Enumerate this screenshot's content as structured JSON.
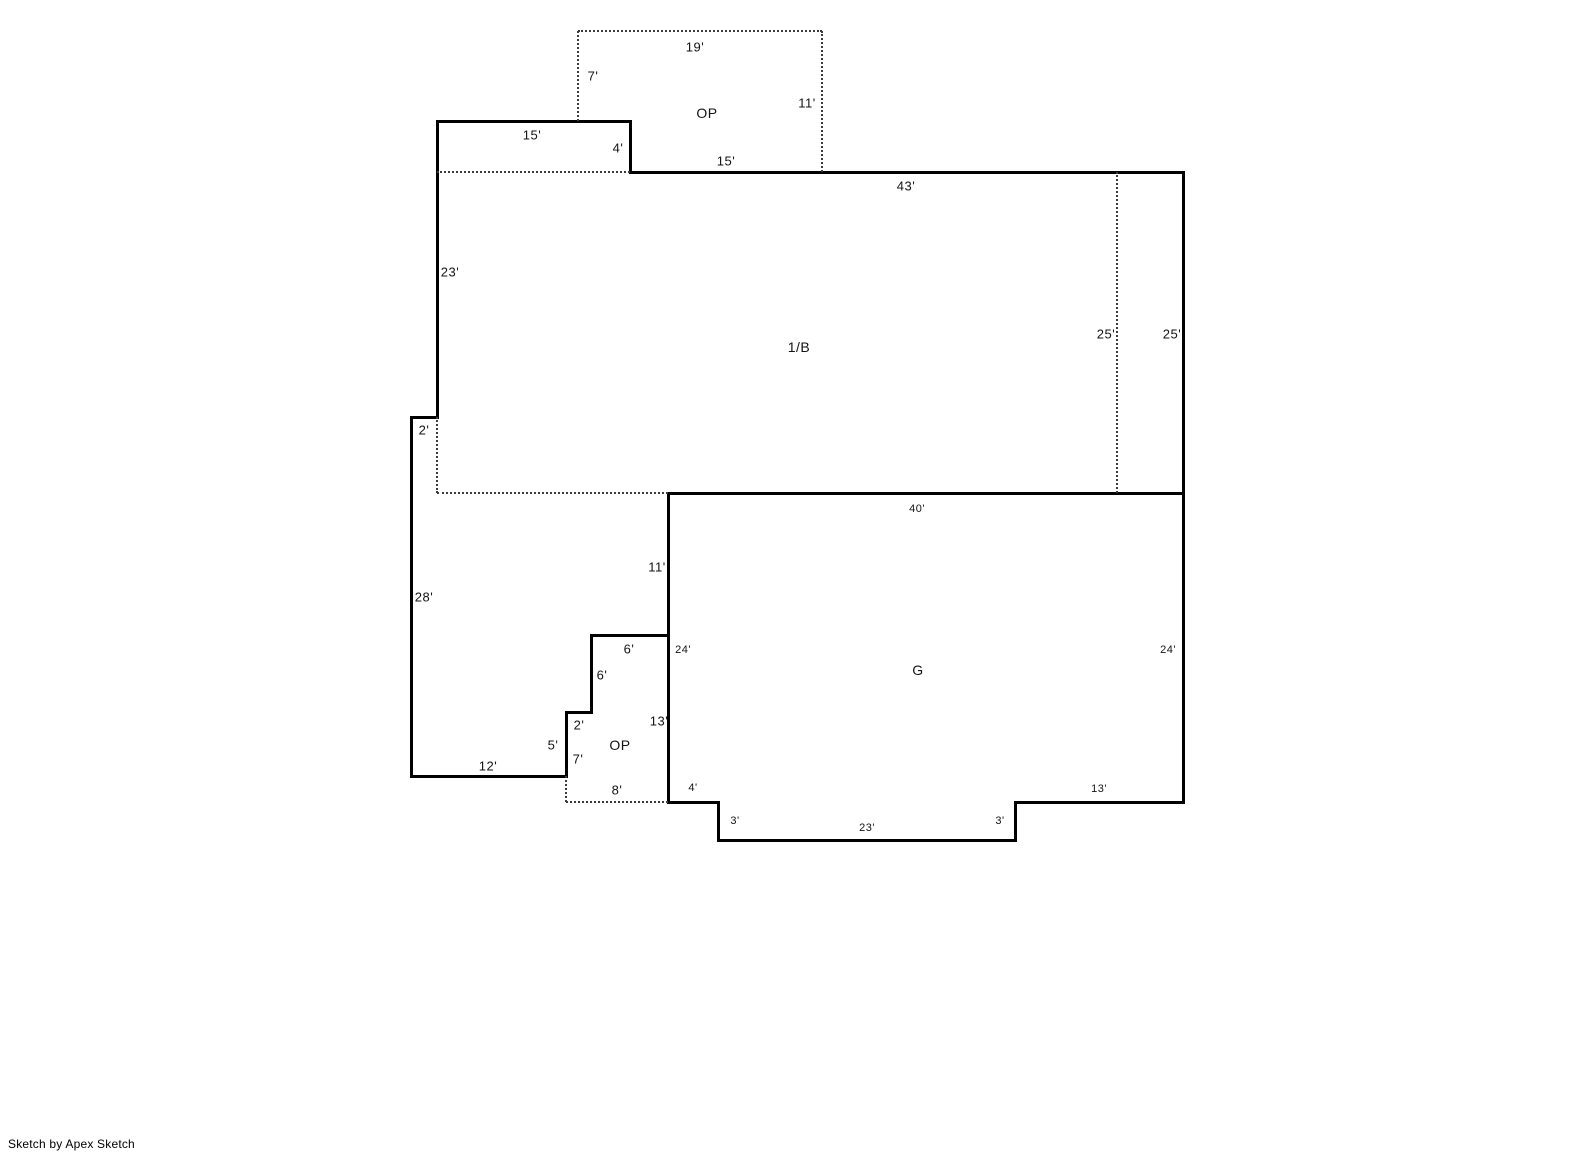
{
  "footer": {
    "credit": "Sketch by Apex Sketch"
  },
  "canvas": {
    "width": 1585,
    "height": 1163,
    "background": "#ffffff",
    "wall_color": "#000000",
    "dotted_color": "#3c3c3c",
    "text_color": "#141414"
  },
  "floorplan": {
    "scale_px_per_foot": 13,
    "area_labels": [
      {
        "text": "OP",
        "name": "area-label-open-porch-top",
        "x": 707,
        "y": 113
      },
      {
        "text": "1/B",
        "name": "area-label-first-floor-basement",
        "x": 799,
        "y": 347
      },
      {
        "text": "G",
        "name": "area-label-garage",
        "x": 918,
        "y": 670
      },
      {
        "text": "OP",
        "name": "area-label-open-porch-bottom",
        "x": 620,
        "y": 745
      }
    ],
    "dimension_labels": [
      {
        "text": "19'",
        "x": 695,
        "y": 47
      },
      {
        "text": "7'",
        "x": 593,
        "y": 76
      },
      {
        "text": "11'",
        "x": 807,
        "y": 103
      },
      {
        "text": "15'",
        "x": 532,
        "y": 135
      },
      {
        "text": "4'",
        "x": 618,
        "y": 148
      },
      {
        "text": "15'",
        "x": 726,
        "y": 161
      },
      {
        "text": "43'",
        "x": 906,
        "y": 186
      },
      {
        "text": "23'",
        "x": 450,
        "y": 272
      },
      {
        "text": "25'",
        "x": 1106,
        "y": 334
      },
      {
        "text": "25'",
        "x": 1172,
        "y": 334
      },
      {
        "text": "2'",
        "x": 424,
        "y": 430
      },
      {
        "text": "40'",
        "x": 917,
        "y": 509,
        "small": true
      },
      {
        "text": "11'",
        "x": 657,
        "y": 567
      },
      {
        "text": "28'",
        "x": 424,
        "y": 597
      },
      {
        "text": "6'",
        "x": 629,
        "y": 649
      },
      {
        "text": "24'",
        "x": 683,
        "y": 650,
        "small": true
      },
      {
        "text": "24'",
        "x": 1168,
        "y": 650,
        "small": true
      },
      {
        "text": "6'",
        "x": 602,
        "y": 675
      },
      {
        "text": "13'",
        "x": 659,
        "y": 721
      },
      {
        "text": "2'",
        "x": 579,
        "y": 725
      },
      {
        "text": "5'",
        "x": 553,
        "y": 745
      },
      {
        "text": "7'",
        "x": 578,
        "y": 759
      },
      {
        "text": "12'",
        "x": 488,
        "y": 766
      },
      {
        "text": "8'",
        "x": 617,
        "y": 790
      },
      {
        "text": "4'",
        "x": 693,
        "y": 788,
        "small": true
      },
      {
        "text": "3'",
        "x": 735,
        "y": 821,
        "small": true
      },
      {
        "text": "23'",
        "x": 867,
        "y": 828,
        "small": true
      },
      {
        "text": "3'",
        "x": 1000,
        "y": 821,
        "small": true
      },
      {
        "text": "13'",
        "x": 1099,
        "y": 789,
        "small": true
      }
    ],
    "solid_walls": [
      [
        437,
        121,
        630,
        121
      ],
      [
        437,
        121,
        437,
        417
      ],
      [
        630,
        121,
        630,
        172
      ],
      [
        630,
        172,
        1183,
        172
      ],
      [
        1183,
        172,
        1183,
        802
      ],
      [
        1015,
        802,
        1183,
        802
      ],
      [
        1015,
        802,
        1015,
        840
      ],
      [
        718,
        840,
        1015,
        840
      ],
      [
        718,
        802,
        718,
        840
      ],
      [
        668,
        802,
        718,
        802
      ],
      [
        668,
        493,
        668,
        802
      ],
      [
        668,
        493,
        1183,
        493
      ],
      [
        591,
        635,
        668,
        635
      ],
      [
        591,
        635,
        591,
        712
      ],
      [
        566,
        712,
        591,
        712
      ],
      [
        566,
        712,
        566,
        776
      ],
      [
        411,
        776,
        566,
        776
      ],
      [
        411,
        417,
        411,
        776
      ],
      [
        411,
        417,
        437,
        417
      ]
    ],
    "dotted_lines": [
      [
        578,
        31,
        822,
        31
      ],
      [
        578,
        31,
        578,
        121
      ],
      [
        822,
        31,
        822,
        172
      ],
      [
        437,
        172,
        630,
        172
      ],
      [
        1117,
        172,
        1117,
        493
      ],
      [
        437,
        417,
        437,
        493
      ],
      [
        437,
        493,
        668,
        493
      ],
      [
        566,
        776,
        566,
        802
      ],
      [
        566,
        802,
        668,
        802
      ]
    ]
  }
}
